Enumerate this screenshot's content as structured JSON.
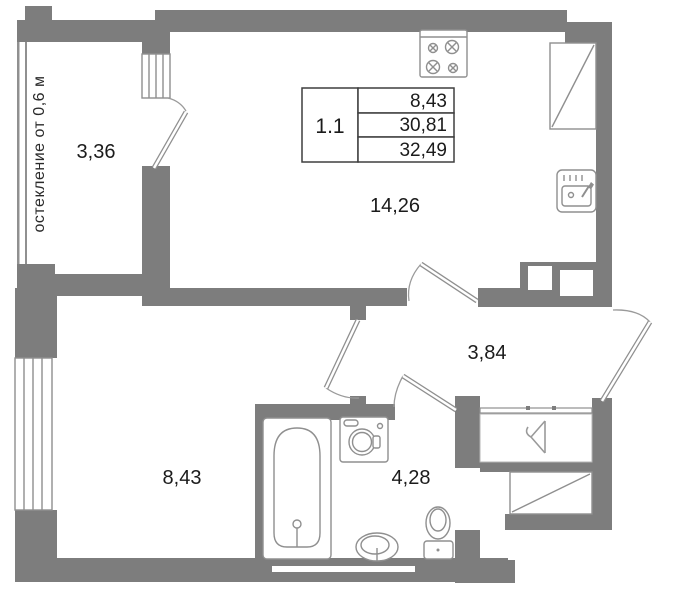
{
  "unit": {
    "label": "1.1"
  },
  "area_table": {
    "values": [
      "8,43",
      "30,81",
      "32,49"
    ]
  },
  "rooms": {
    "balcony": "3,36",
    "kitchen_living": "14,26",
    "hall": "3,84",
    "bedroom": "8,43",
    "bathroom": "4,28"
  },
  "annotations": {
    "glazing_note": "остекление от 0,6 м"
  },
  "icons": {
    "kitchen": [
      "stove-icon",
      "kitchen-sink-icon",
      "fridge-shaft-icon"
    ],
    "bathroom": [
      "bathtub-icon",
      "washing-machine-icon",
      "bathroom-sink-icon",
      "toilet-icon"
    ],
    "hall": [
      "hanger-icon",
      "vent-shaft-icon"
    ]
  },
  "colors": {
    "wall": "#7d7d7d",
    "outline": "#8f8f8f",
    "text": "#1b1b1b",
    "background": "#ffffff"
  }
}
